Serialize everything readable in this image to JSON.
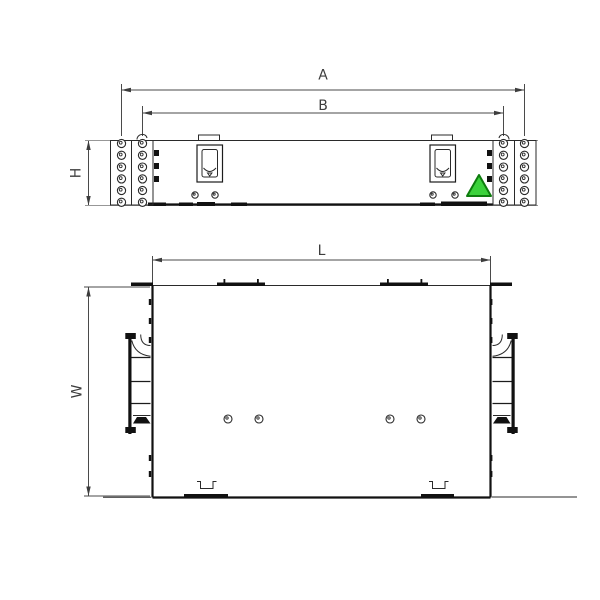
{
  "labels": {
    "front_width_outer": "A",
    "front_width_inner": "B",
    "front_height": "H",
    "plan_length": "L",
    "plan_width": "W"
  },
  "colors": {
    "object_line": "#1c1c1c",
    "auxiliary_line": "#979797",
    "dimension_line": "#4a4a4a",
    "triangle_fill": "#3cd23c",
    "triangle_stroke": "#0e7c0e"
  },
  "counts": {
    "ear_hole_rows": 6,
    "ear_hole_columns_per_ear": 2,
    "plan_screw_holes": 4,
    "front_latches": 2
  }
}
